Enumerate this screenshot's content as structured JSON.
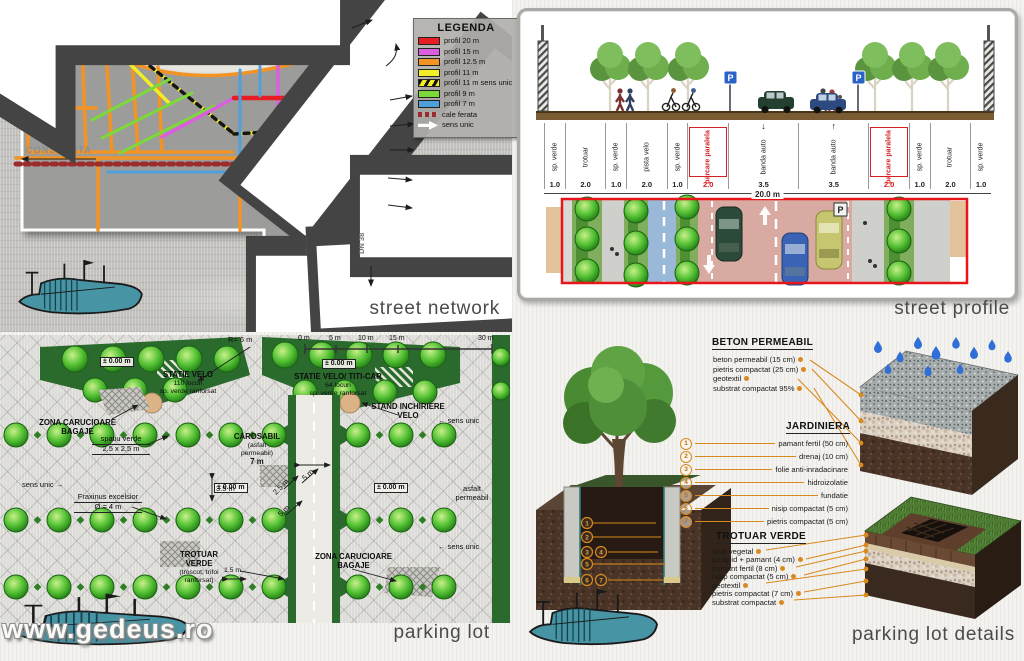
{
  "captions": {
    "street_network": "street network",
    "street_profile": "street profile",
    "parking_lot": "parking lot",
    "parking_lot_details": "parking lot details"
  },
  "watermark": "www.gedeus.ro",
  "colors": {
    "profil_20": "#e81c23",
    "profil_15": "#db5ede",
    "profil_12_5": "#f39324",
    "profil_11": "#f2ee25",
    "profil_9": "#7cd93a",
    "profil_7": "#4f9fd9",
    "cale_ferata": "#9c2c2c",
    "accent_orange": "#d98a1f",
    "dark_green": "#2a6b2d",
    "red_frame": "#e8151a"
  },
  "legend": {
    "title": "LEGENDA",
    "items": [
      {
        "label": "profil 20 m",
        "style": "solid",
        "color": "#e81c23"
      },
      {
        "label": "profil 15 m",
        "style": "solid",
        "color": "#db5ede"
      },
      {
        "label": "profil 12.5 m",
        "style": "solid",
        "color": "#f39324"
      },
      {
        "label": "profil 11 m",
        "style": "solid",
        "color": "#f2ee25"
      },
      {
        "label": "profil 11 m sens unic",
        "style": "hatched",
        "color": "#f2ee25"
      },
      {
        "label": "profil 9 m",
        "style": "solid",
        "color": "#7cd93a"
      },
      {
        "label": "profil 7 m",
        "style": "solid",
        "color": "#4f9fd9"
      },
      {
        "label": "cale ferata",
        "style": "dashed",
        "color": "#9c2c2c"
      },
      {
        "label": "sens unic",
        "style": "arrow",
        "color": "#ffffff"
      }
    ]
  },
  "map": {
    "constanta": "CONSTANTA",
    "dn38": "DN 38"
  },
  "street_profile": {
    "p_sign": "P",
    "segments": [
      {
        "label": "sp. verde",
        "width": "1.0",
        "flex": 1
      },
      {
        "label": "trotuar",
        "width": "2.0",
        "flex": 2
      },
      {
        "label": "sp. verde",
        "width": "1.0",
        "flex": 1
      },
      {
        "label": "pista velo",
        "width": "2.0",
        "flex": 2
      },
      {
        "label": "sp. verde",
        "width": "1.0",
        "flex": 1
      },
      {
        "label": "parcare paralela",
        "width": "2.0",
        "flex": 2,
        "red": "true"
      },
      {
        "label": "banda auto",
        "width": "3.5",
        "flex": 3.5,
        "arrow": "↓"
      },
      {
        "label": "banda auto",
        "width": "3.5",
        "flex": 3.5,
        "arrow": "↑"
      },
      {
        "label": "parcare paralela",
        "width": "2.0",
        "flex": 2,
        "red": "true"
      },
      {
        "label": "sp. verde",
        "width": "1.0",
        "flex": 1
      },
      {
        "label": "trotuar",
        "width": "2.0",
        "flex": 2
      },
      {
        "label": "sp. verde",
        "width": "1.0",
        "flex": 1
      }
    ],
    "total": "20.0 m"
  },
  "parking_lot": {
    "scale": [
      "0 m",
      "5 m",
      "10 m",
      "15 m",
      "30 m"
    ],
    "labels": {
      "r6": "R= 6 m",
      "zero": "± 0.00 m",
      "statie1": [
        "STATIE VELO",
        "110 locuri",
        "sp. verde ranforsat"
      ],
      "statie2": [
        "STATIE VELO/ TITI-CAR",
        "64 locuri",
        "sp. verde ranforsat"
      ],
      "zona_carucioare": [
        "ZONA CARUCIOARE",
        "BAGAJE"
      ],
      "spatiu_verde": [
        "spatiu verde",
        "2.5 x 2.5 m"
      ],
      "stand": [
        "STAND INCHIRIERE",
        "VELO"
      ],
      "sens_unic": "sens unic",
      "fraxinus": [
        "Fraxinus excelsior",
        "Ø = 4 m"
      ],
      "carosabil": [
        "CAROSABIL",
        "(asfalt",
        "permeabil)"
      ],
      "carosabil_w": "7 m",
      "trotuar_verde": [
        "TROTUAR",
        "VERDE",
        "(troscot; trifoi",
        "ranforsat)"
      ],
      "asfalt": [
        "asfalt",
        "permeabil"
      ],
      "d35": "3.5 m",
      "d25": "2.5 m",
      "d5": "5 m",
      "d15": "1.5 m",
      "arrow_left": "←",
      "arrow_right": "→"
    }
  },
  "details": {
    "beton": {
      "title": "BETON PERMEABIL",
      "items": [
        "beton permeabil (15 cm)",
        "pietris compactat (25 cm)",
        "geotextil",
        "substrat compactat 95%"
      ]
    },
    "jardiniera": {
      "title": "JARDINIERA",
      "items": [
        {
          "num": "1",
          "label": "pamant fertil (50 cm)"
        },
        {
          "num": "2",
          "label": "drenaj (10 cm)"
        },
        {
          "num": "3",
          "label": "folie anti-inradacinare"
        },
        {
          "num": "4",
          "label": "hidroizolatie"
        },
        {
          "num": "5",
          "label": "fundatie"
        },
        {
          "num": "6",
          "label": "nisip compactat (5 cm)"
        },
        {
          "num": "7",
          "label": "pietris compactat (5 cm)"
        }
      ]
    },
    "trotuar": {
      "title": "TROTUAR VERDE",
      "items": [
        "strat vegetal",
        "geogrid + pamant (4 cm)",
        "pamant fertil (8 cm)",
        "nisip compactat (5 cm)",
        "geotextil",
        "pietris compactat (7 cm)",
        "substrat compactat"
      ]
    }
  }
}
